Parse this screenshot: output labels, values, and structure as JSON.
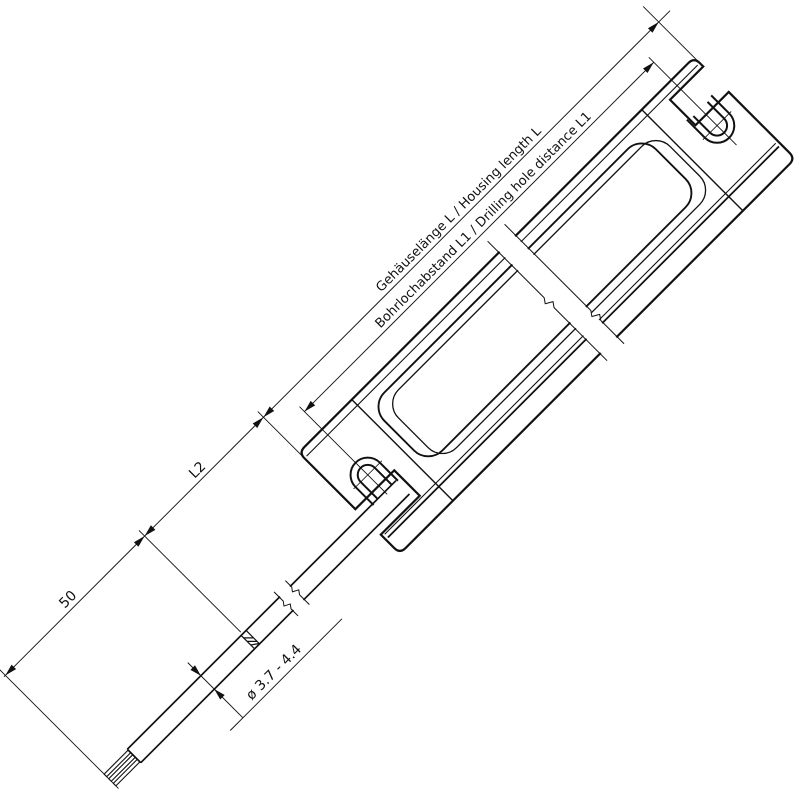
{
  "drawing": {
    "type": "technical-dimension-drawing",
    "subject": "LED driver housing with connection cable, isometric 45-degree view",
    "line_color": "#111111",
    "background_color": "#ffffff",
    "dimension_labels": {
      "housing_length": "Gehäuselänge L / Housing length L",
      "drill_hole_distance": "Bohrlochabstand L1 / Drilling hole distance L1",
      "cable_section": "L2",
      "strip_length": "50",
      "cable_diameter": "ø 3.7 - 4.4"
    }
  }
}
